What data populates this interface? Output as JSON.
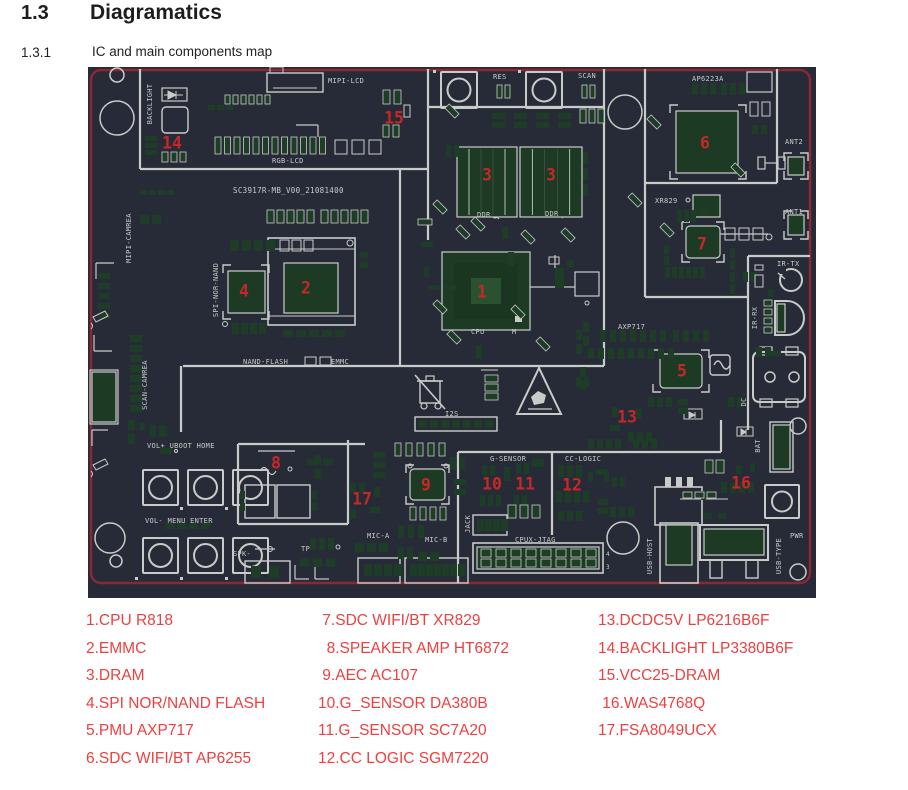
{
  "header": {
    "section_number": "1.3",
    "section_title": "Diagramatics",
    "subsection_number": "1.3.1",
    "subsection_title": "IC and main components map"
  },
  "colors": {
    "board_bg": "#272b37",
    "silkscreen": "#c8ccc8",
    "pad_green": "#1e3d26",
    "chip_green": "#1d3a24",
    "board_border_red": "#8e2733",
    "marker_red": "#c62828",
    "legend_red": "#ee4040",
    "heading_text": "#1d1d1f"
  },
  "board": {
    "board_id": "SC3917R-MB_V00_21081400",
    "silk_labels": [
      {
        "t": "MIPI-LCD",
        "x": 240,
        "y": 16
      },
      {
        "t": "RGB-LCD",
        "x": 184,
        "y": 96
      },
      {
        "t": "SC3917R-MB_V00_21081400",
        "x": 145,
        "y": 126,
        "s": 7.5
      },
      {
        "t": "BACKLIGHT",
        "x": 62,
        "y": 37,
        "r": 1
      },
      {
        "t": "MIPI-CAMREA",
        "x": 41,
        "y": 171,
        "r": 1
      },
      {
        "t": "SCAN-CAMREA",
        "x": 57,
        "y": 318,
        "r": 1
      },
      {
        "t": "SPI-NOR-NAND",
        "x": 128,
        "y": 223,
        "r": 1
      },
      {
        "t": "NAND-FLASH",
        "x": 155,
        "y": 297
      },
      {
        "t": "EMMC",
        "x": 243,
        "y": 297
      },
      {
        "t": "RES",
        "x": 405,
        "y": 12
      },
      {
        "t": "SCAN",
        "x": 490,
        "y": 11
      },
      {
        "t": "DDR",
        "x": 389,
        "y": 150
      },
      {
        "t": "DDR",
        "x": 457,
        "y": 149
      },
      {
        "t": "CPU",
        "x": 383,
        "y": 267
      },
      {
        "t": "M",
        "x": 424,
        "y": 267
      },
      {
        "t": "AP6223A",
        "x": 604,
        "y": 14
      },
      {
        "t": "ANT2",
        "x": 697,
        "y": 77
      },
      {
        "t": "XR829",
        "x": 567,
        "y": 136
      },
      {
        "t": "ANT1",
        "x": 697,
        "y": 147
      },
      {
        "t": "IR-TX",
        "x": 689,
        "y": 199
      },
      {
        "t": "IR-RX",
        "x": 667,
        "y": 251,
        "r": 1
      },
      {
        "t": "AXP717",
        "x": 530,
        "y": 262
      },
      {
        "t": "DC",
        "x": 656,
        "y": 335,
        "r": 1
      },
      {
        "t": "VOL+ UBOOT HOME",
        "x": 59,
        "y": 381
      },
      {
        "t": "VOL- MENU ENTER",
        "x": 57,
        "y": 456
      },
      {
        "t": "SPK-",
        "x": 145,
        "y": 489
      },
      {
        "t": "TP",
        "x": 213,
        "y": 484
      },
      {
        "t": "G-SENSOR",
        "x": 402,
        "y": 394
      },
      {
        "t": "CC-LOGIC",
        "x": 477,
        "y": 394
      },
      {
        "t": "MIC-A",
        "x": 279,
        "y": 471
      },
      {
        "t": "MIC-B",
        "x": 337,
        "y": 475
      },
      {
        "t": "JACK",
        "x": 380,
        "y": 457,
        "r": 1
      },
      {
        "t": "CPUX-JTAG",
        "x": 427,
        "y": 475
      },
      {
        "t": "I2S",
        "x": 357,
        "y": 349
      },
      {
        "t": "BAT",
        "x": 670,
        "y": 379,
        "r": 1
      },
      {
        "t": "USB-HOST",
        "x": 562,
        "y": 489,
        "r": 1
      },
      {
        "t": "USB-TYPE",
        "x": 691,
        "y": 489,
        "r": 1
      },
      {
        "t": "PWR",
        "x": 702,
        "y": 471
      },
      {
        "t": "4",
        "x": 518,
        "y": 489,
        "s": 6
      },
      {
        "t": "3",
        "x": 518,
        "y": 502,
        "s": 6
      }
    ],
    "markers": [
      {
        "n": "1",
        "x": 394,
        "y": 225
      },
      {
        "n": "2",
        "x": 218,
        "y": 221
      },
      {
        "n": "3",
        "x": 399,
        "y": 108
      },
      {
        "n": "3",
        "x": 463,
        "y": 108
      },
      {
        "n": "4",
        "x": 156,
        "y": 224
      },
      {
        "n": "5",
        "x": 594,
        "y": 304
      },
      {
        "n": "6",
        "x": 617,
        "y": 76
      },
      {
        "n": "7",
        "x": 614,
        "y": 177
      },
      {
        "n": "8",
        "x": 188,
        "y": 396
      },
      {
        "n": "9",
        "x": 338,
        "y": 418
      },
      {
        "n": "10",
        "x": 404,
        "y": 417
      },
      {
        "n": "11",
        "x": 437,
        "y": 417
      },
      {
        "n": "12",
        "x": 484,
        "y": 418
      },
      {
        "n": "13",
        "x": 539,
        "y": 350
      },
      {
        "n": "14",
        "x": 84,
        "y": 76
      },
      {
        "n": "15",
        "x": 306,
        "y": 51
      },
      {
        "n": "16",
        "x": 653,
        "y": 416
      },
      {
        "n": "17",
        "x": 274,
        "y": 432
      }
    ]
  },
  "legend": {
    "columns": [
      [
        "1.CPU R818",
        "2.EMMC",
        "3.DRAM",
        "4.SPI NOR/NAND FLASH",
        "5.PMU AXP717",
        "6.SDC WIFI/BT AP6255"
      ],
      [
        " 7.SDC WIFI/BT XR829",
        "  8.SPEAKER AMP HT6872",
        " 9.AEC AC107",
        "10.G_SENSOR DA380B",
        "11.G_SENSOR SC7A20",
        "12.CC LOGIC SGM7220"
      ],
      [
        "13.DCDC5V LP6216B6F",
        "14.BACKLIGHT LP3380B6F",
        "15.VCC25-DRAM",
        " 16.WAS4768Q",
        "17.FSA8049UCX"
      ]
    ]
  }
}
